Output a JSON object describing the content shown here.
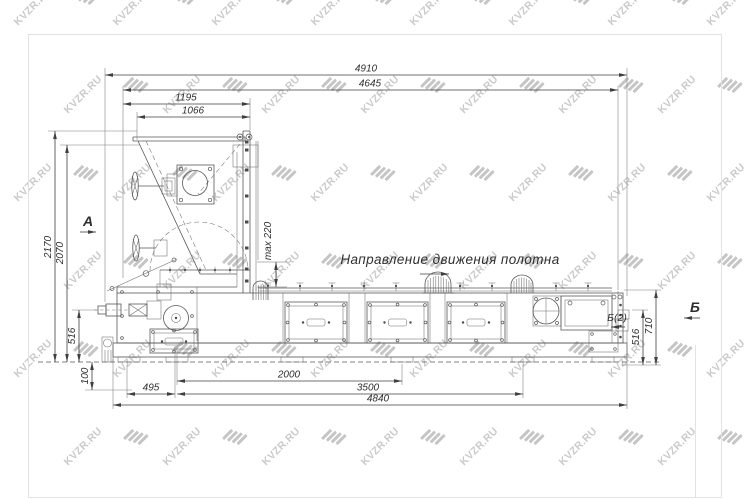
{
  "watermark": {
    "text": "KVZR.RU"
  },
  "annotations": {
    "direction_label": "Направление движения полотна",
    "section_view_a": "А",
    "section_view_b": "Б",
    "section_view_b2": "Б(2)",
    "max_gap_label": "max 220"
  },
  "dims": {
    "top": [
      "4910",
      "4645",
      "1195",
      "1066"
    ],
    "left": [
      "2170",
      "2070",
      "516",
      "100"
    ],
    "bottom": [
      "495",
      "2000",
      "3500",
      "4840"
    ],
    "right": [
      "516",
      "710"
    ]
  },
  "colors": {
    "line": "#575757",
    "dimension": "#3f3f3f",
    "watermark": "#bdbdbd",
    "sheet_frame": "#e2e2e2",
    "background": "#ffffff"
  }
}
